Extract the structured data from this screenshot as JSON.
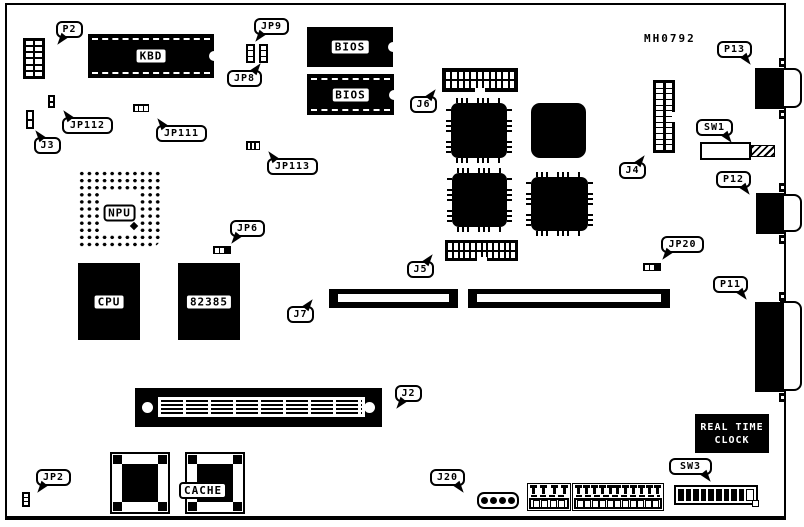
{
  "board_code": "MH0792",
  "labels": {
    "p2": "P2",
    "jp9": "JP9",
    "jp8": "JP8",
    "j3": "J3",
    "jp112": "JP112",
    "jp111": "JP111",
    "jp113": "JP113",
    "kbd": "KBD",
    "bios_top": "BIOS",
    "bios_bottom": "BIOS",
    "j6": "J6",
    "j4": "J4",
    "j5": "J5",
    "j7": "J7",
    "j2": "J2",
    "j20": "J20",
    "p13": "P13",
    "p12": "P12",
    "p11": "P11",
    "sw1": "SW1",
    "sw3": "SW3",
    "npu": "NPU",
    "cpu": "CPU",
    "chip82385": "82385",
    "cache": "CACHE",
    "jp6": "JP6",
    "jp20": "JP20",
    "jp2": "JP2",
    "rtc_line1": "REAL TIME",
    "rtc_line2": "CLOCK"
  }
}
